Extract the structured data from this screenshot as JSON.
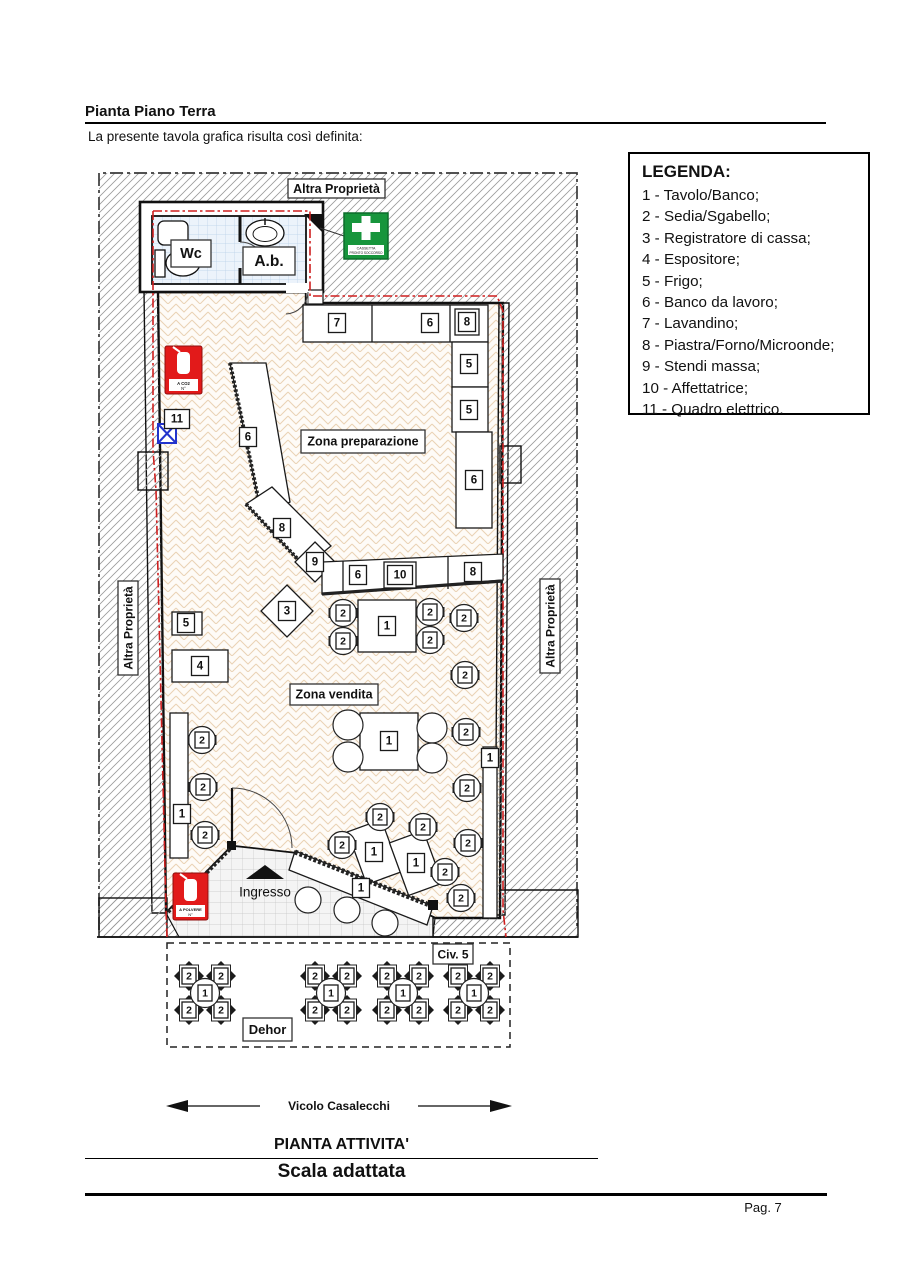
{
  "page": {
    "title": "Pianta Piano Terra",
    "intro": "La presente tavola grafica risulta così definita:",
    "page_number": "Pag.  7"
  },
  "legend": {
    "title": "LEGENDA:",
    "items": [
      "1 - Tavolo/Banco;",
      "2 - Sedia/Sgabello;",
      "3 - Registratore di cassa;",
      "4 - Espositore;",
      "5 - Frigo;",
      "6 - Banco da lavoro;",
      "7 - Lavandino;",
      "8 - Piastra/Forno/Microonde;",
      "9 - Stendi massa;",
      "10 - Affettatrice;",
      "11 - Quadro elettrico."
    ]
  },
  "plan": {
    "area_labels": {
      "other_property_top": "Altra Proprietà",
      "other_property_left": "Altra Proprietà",
      "other_property_right": "Altra Proprietà",
      "wc": "Wc",
      "ab": "A.b.",
      "prep_zone": "Zona preparazione",
      "sales_zone": "Zona vendita",
      "entrance": "Ingresso",
      "civic": "Civ. 5",
      "dehor": "Dehor"
    },
    "signs": {
      "first_aid_1": "CASSETTA",
      "first_aid_2": "PRONTO SOCCORSO",
      "ext_co2_1": "A CO2",
      "ext_co2_2": "N°",
      "ext_powder_1": "A POLVERE",
      "ext_powder_2": "N°"
    },
    "street": "Vicolo Casalecchi",
    "furniture_boxes": [
      {
        "t": "7",
        "x": 337,
        "y": 323
      },
      {
        "t": "6",
        "x": 430,
        "y": 323
      },
      {
        "t": "8",
        "x": 467,
        "y": 322,
        "d": true
      },
      {
        "t": "5",
        "x": 469,
        "y": 364
      },
      {
        "t": "5",
        "x": 469,
        "y": 410
      },
      {
        "t": "6",
        "x": 474,
        "y": 480
      },
      {
        "t": "6",
        "x": 248,
        "y": 437
      },
      {
        "t": "8",
        "x": 282,
        "y": 528
      },
      {
        "t": "9",
        "x": 315,
        "y": 562
      },
      {
        "t": "6",
        "x": 358,
        "y": 575
      },
      {
        "t": "10",
        "x": 400,
        "y": 575,
        "d": true
      },
      {
        "t": "8",
        "x": 473,
        "y": 572
      },
      {
        "t": "3",
        "x": 287,
        "y": 611
      },
      {
        "t": "5",
        "x": 186,
        "y": 623
      },
      {
        "t": "4",
        "x": 200,
        "y": 666
      },
      {
        "t": "11",
        "x": 177,
        "y": 419
      },
      {
        "t": "1",
        "x": 387,
        "y": 626
      },
      {
        "t": "1",
        "x": 389,
        "y": 741
      },
      {
        "t": "1",
        "x": 182,
        "y": 814
      },
      {
        "t": "1",
        "x": 490,
        "y": 758
      },
      {
        "t": "1",
        "x": 374,
        "y": 852
      },
      {
        "t": "1",
        "x": 416,
        "y": 863
      },
      {
        "t": "1",
        "x": 361,
        "y": 888
      }
    ],
    "chairs": [
      [
        343,
        613
      ],
      [
        343,
        641
      ],
      [
        430,
        612
      ],
      [
        430,
        640
      ],
      [
        464,
        618
      ],
      [
        465,
        675
      ],
      [
        466,
        732
      ],
      [
        467,
        788
      ],
      [
        468,
        843
      ],
      [
        461,
        898
      ],
      [
        202,
        740
      ],
      [
        203,
        787
      ],
      [
        205,
        835
      ],
      [
        342,
        845
      ],
      [
        380,
        817
      ],
      [
        423,
        827
      ],
      [
        445,
        872
      ]
    ],
    "chair_label": "2",
    "plain_circles": [
      [
        348,
        725,
        15
      ],
      [
        348,
        757,
        15
      ],
      [
        432,
        728,
        15
      ],
      [
        432,
        758,
        15
      ],
      [
        308,
        900,
        13
      ],
      [
        347,
        910,
        13
      ],
      [
        385,
        923,
        13
      ]
    ],
    "dehor_groups": {
      "table_label": "1",
      "chair_label": "2",
      "centers": [
        [
          205,
          993
        ],
        [
          331,
          993
        ],
        [
          403,
          993
        ],
        [
          474,
          993
        ]
      ]
    }
  }
}
